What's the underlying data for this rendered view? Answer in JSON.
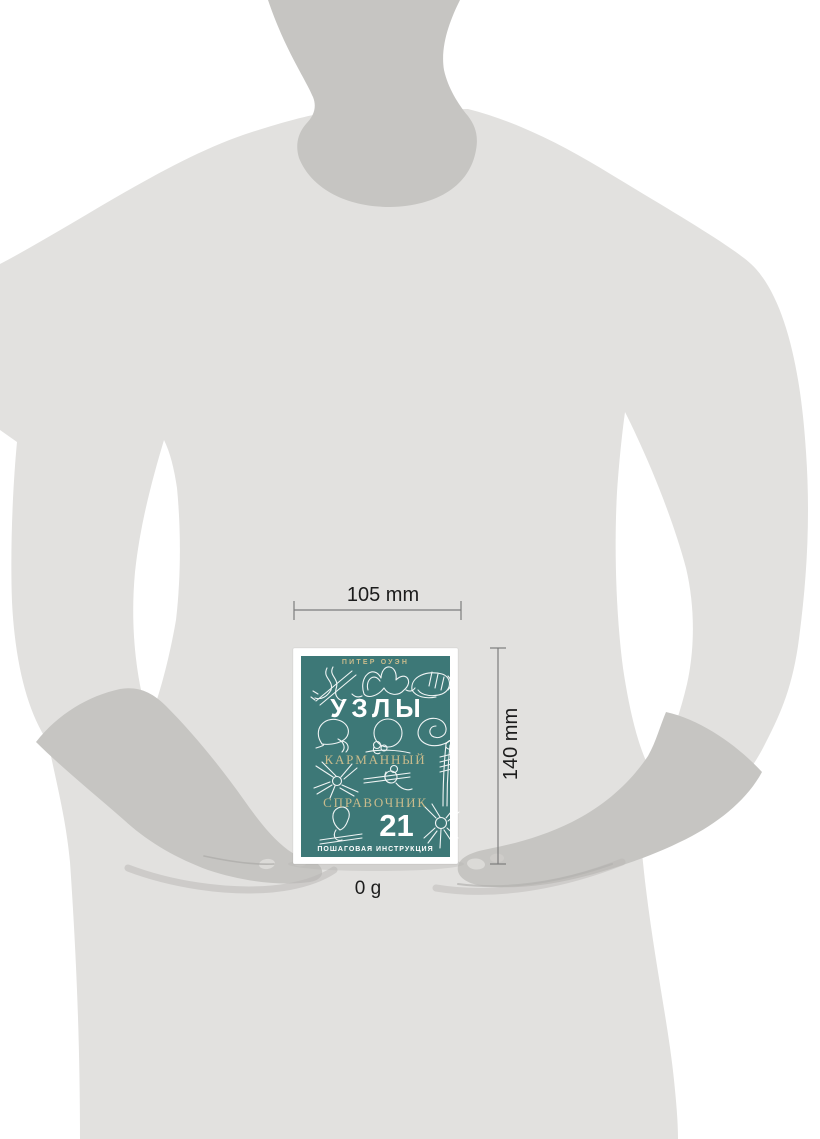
{
  "dimensions": {
    "width_label": "105 mm",
    "height_label": "140 mm",
    "weight_label": "0 g"
  },
  "book_cover": {
    "author": "ПИТЕР ОУЭН",
    "title": "УЗЛЫ",
    "subtitle_top": "КАРМАННЫЙ",
    "subtitle_bottom": "СПРАВОЧНИК",
    "knot_count": "21",
    "tagline": "ПОШАГОВАЯ ИНСТРУКЦИЯ"
  },
  "colors": {
    "page_background": "#ffffff",
    "figure_body_gray": "#e2e1df",
    "figure_skin_gray": "#c6c5c2",
    "cover_teal": "#3d7877",
    "cover_gold": "#c9bb8c",
    "cover_line_art": "#ffffff",
    "dimension_line": "#7d7d7d",
    "dimension_text": "#1c1c1c"
  }
}
